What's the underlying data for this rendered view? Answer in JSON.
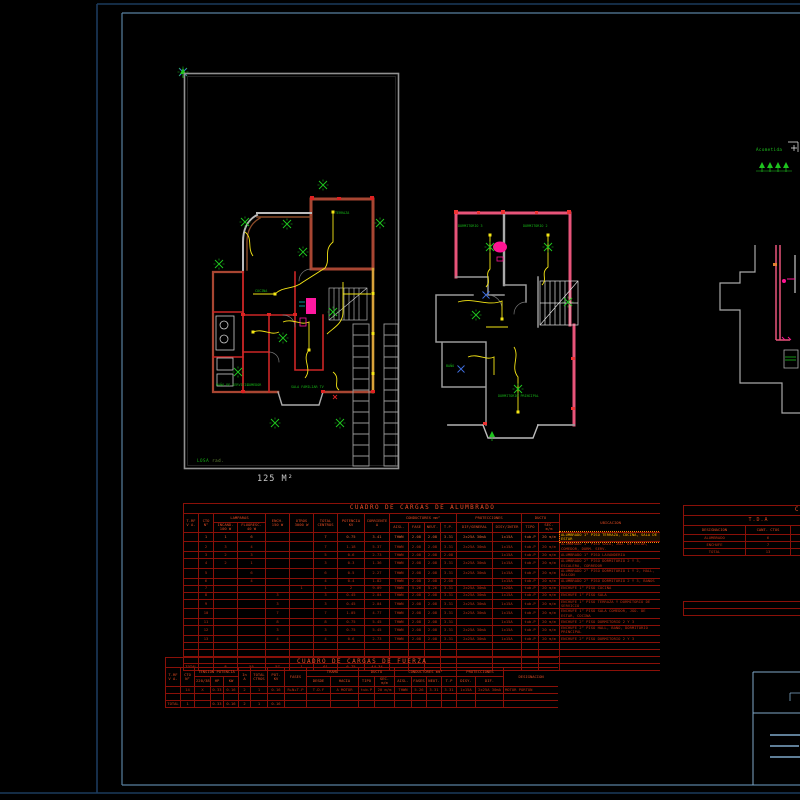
{
  "annotation": {
    "text": "Acometida"
  },
  "plans": {
    "plan1": {
      "area_label": "125 M²",
      "note": "LOSA",
      "note2": "rad.",
      "rooms": {
        "terraza": "TERRAZA",
        "cocina": "COCINA",
        "bano_servicio": "BAÑO DE\nSERVICIO",
        "comedor": "COMEDOR",
        "sala_tv": "SALA\nFAMILIAR TV"
      }
    },
    "plan2": {
      "rooms": {
        "dorm3": "DORMITORIO\n3",
        "dorm2": "DORMITORIO\n2",
        "bano": "BAÑO",
        "dorm_ppal": "DORMITORIO\nPRINCIPAL"
      }
    }
  },
  "colors": {
    "background": "#000000",
    "frame_outer": "#1b3a5c",
    "frame_inner": "#58809f",
    "titleblock": "#7fa8c9",
    "table_line": "#8a1008",
    "table_text": "#c23012",
    "highlight": "#ffb400",
    "wall_orange": "#a84632",
    "wall_pink": "#e8547a",
    "wire_yellow": "#f5e615",
    "symbol_green": "#1ec41e",
    "boundary_gray": "#909090"
  },
  "tables": [
    {
      "id": "alumbrado",
      "title": "CUADRO DE CARGAS DE ALUMBRADO",
      "col_widths": [
        15,
        15,
        24,
        28,
        24,
        24,
        24,
        27,
        25,
        19,
        16,
        16,
        16,
        36,
        29,
        17,
        21,
        102
      ],
      "header_rows": [
        [
          {
            "t": "CUADRO DE CARGAS DE ALUMBRADO",
            "cs": 18,
            "cls": "title"
          }
        ],
        [
          {
            "t": "T.RF\nV A.",
            "rs": 2
          },
          {
            "t": "CTO\nN°",
            "rs": 2
          },
          {
            "t": "LAMPARAS",
            "cs": 2
          },
          {
            "t": "ENCH.\n150 W",
            "rs": 2
          },
          {
            "t": "OTROS\n3000 W",
            "rs": 2
          },
          {
            "t": "TOTAL\nCENTROS",
            "rs": 2
          },
          {
            "t": "POTENCIA\nKV",
            "rs": 2
          },
          {
            "t": "CORRIENTE\nA",
            "rs": 2
          },
          {
            "t": "CONDUCTORES mm²",
            "cs": 4
          },
          {
            "t": "PROTECCIONES",
            "cs": 2
          },
          {
            "t": "DUCTO",
            "cs": 2
          },
          {
            "t": "UBICACION",
            "rs": 2
          }
        ],
        [
          {
            "t": "INCAND.\n100 W"
          },
          {
            "t": "FLUORESC.\n40 W"
          },
          {
            "t": "AISL."
          },
          {
            "t": "FASE"
          },
          {
            "t": "NEUT."
          },
          {
            "t": "T.P."
          },
          {
            "t": "DIF/GENERAL"
          },
          {
            "t": "DISY/INTER"
          },
          {
            "t": "TIPO"
          },
          {
            "t": "SEC. m/m"
          }
        ]
      ],
      "highlight_row": 0,
      "rows": [
        [
          "",
          "1",
          "1",
          "6",
          "",
          "",
          "7",
          "0.75",
          "3.41",
          "THWN",
          "2.08",
          "2.08",
          "3.31",
          "2x25A 30mA",
          "1x15A",
          "tub.P",
          "20 m/m",
          "ALUMBRADO 1° PISO TERRAZA, COCINA, SALA DE ESTAR"
        ],
        [
          "",
          "2",
          "3",
          "4",
          "",
          "",
          "7",
          "1.18",
          "5.37",
          "THWN",
          "2.08",
          "2.08",
          "3.31",
          "2x25A 30mA",
          "1x15A",
          "tub.P",
          "20 m/m",
          "ALUMBRADO 1° PISO SALA, JGO. DE ESTAR, COMEDOR, DORM. SERV."
        ],
        [
          "",
          "3",
          "2",
          "3",
          "",
          "",
          "5",
          "0.6",
          "2.73",
          "THWN",
          "2.08",
          "2.08",
          "2.08",
          "",
          "1x15A",
          "tub.P",
          "20 m/m",
          "ALUMBRADO 1° PISO LAVANDERIA"
        ],
        [
          "",
          "4",
          "2",
          "1",
          "",
          "",
          "3",
          "0.3",
          "1.36",
          "THWN",
          "2.08",
          "2.08",
          "3.31",
          "2x25A 30mA",
          "1x15A",
          "tub.P",
          "20 m/m",
          "ALUMBRADO 2° PISO DORMITORIO 2 Y 3, ESCALERA, CORREDOR"
        ],
        [
          "",
          "5",
          "",
          "6",
          "",
          "",
          "6",
          "0.5",
          "2.27",
          "THWN",
          "2.08",
          "2.08",
          "3.31",
          "2x25A 30mA",
          "1x15A",
          "tub.P",
          "20 m/m",
          "ALUMBRADO 2° PISO DORMITORIO 1 Y 2, HALL, BALCON"
        ],
        [
          "",
          "6",
          "",
          "4",
          "",
          "",
          "4",
          "0.4",
          "1.82",
          "THWN",
          "2.08",
          "2.08",
          "2.08",
          "",
          "1x15A",
          "tub.P",
          "20 m/m",
          "ALUMBRADO 2° PISO DORMITORIO 2 Y 3, BAÑOS"
        ],
        [
          "",
          "7",
          "",
          "",
          "",
          "1",
          "1",
          "2",
          "9.09",
          "THWN",
          "5.26",
          "5.26",
          "3.31",
          "2x25A 30mA",
          "1x20A",
          "tub.P",
          "20 m/m",
          "ENCHUFE 1° PISO COCINA"
        ],
        [
          "",
          "8",
          "",
          "",
          "3",
          "",
          "3",
          "0.45",
          "2.04",
          "THWN",
          "2.08",
          "2.08",
          "3.31",
          "2x25A 30mA",
          "1x15A",
          "tub.P",
          "20 m/m",
          "ENCHUFE 1° PISO SALA"
        ],
        [
          "",
          "9",
          "",
          "",
          "3",
          "",
          "3",
          "0.45",
          "2.04",
          "THWN",
          "2.08",
          "2.08",
          "3.31",
          "2x25A 30mA",
          "1x15A",
          "tub.P",
          "20 m/m",
          "ENCHUFE 1° PISO TERRAZA Y DORMITORIO DE SERVICIO"
        ],
        [
          "",
          "10",
          "",
          "",
          "7",
          "",
          "7",
          "1.05",
          "4.77",
          "THWN",
          "2.08",
          "2.08",
          "3.31",
          "2x25A 30mA",
          "1x15A",
          "tub.P",
          "20 m/m",
          "ENCHUFE 1° PISO SALA COMEDOR, JGO. DE ESTAR, COCINA"
        ],
        [
          "",
          "11",
          "",
          "",
          "8",
          "",
          "8",
          "0.75",
          "5.45",
          "THWN",
          "2.08",
          "2.08",
          "3.31",
          "",
          "1x15A",
          "tub.P",
          "20 m/m",
          "ENCHUFE 2° PISO DORMITORIO 2 Y 3"
        ],
        [
          "",
          "12",
          "",
          "",
          "3",
          "",
          "3",
          "0.75",
          "5.45",
          "THWN",
          "2.08",
          "2.08",
          "3.31",
          "2x25A 30mA",
          "1x15A",
          "tub.P",
          "20 m/m",
          "ENCHUFE 2° PISO HALL, BAÑO, DORMITORIO PRINCIPAL"
        ],
        [
          "",
          "13",
          "",
          "",
          "4",
          "",
          "4",
          "0.6",
          "2.73",
          "THWN",
          "2.08",
          "2.08",
          "3.31",
          "2x25A 30mA",
          "1x15A",
          "tub.P",
          "20 m/m",
          "ENCHUFE 2° PISO DORMITORIO 2 Y 3"
        ]
      ],
      "empty_rows": 3,
      "total": [
        "TOTAL",
        "",
        "8",
        "55",
        "57",
        "1",
        "61",
        "6.75",
        "44.34",
        "",
        "",
        "",
        "",
        "",
        "",
        "",
        "",
        ""
      ]
    },
    {
      "id": "tda",
      "title": "CUADRO",
      "table_width": 150,
      "col_widths": [
        62,
        45,
        43
      ],
      "header_rows": [
        [
          {
            "t": "CUADRO",
            "cs": 3,
            "cls": "title title-right"
          }
        ],
        [
          {
            "t": "T.D.A",
            "cs": 3,
            "cls": "sub"
          }
        ],
        [
          {
            "t": "DESIGNACION"
          },
          {
            "t": "CANT. CTOS"
          },
          {
            "t": "POTENCIA"
          }
        ]
      ],
      "rows": [
        [
          "ALUMBRADO",
          "6",
          ""
        ],
        [
          "ENCHUFE",
          "7",
          ""
        ],
        [
          "TOTAL",
          "13",
          ""
        ]
      ]
    },
    {
      "id": "tda-extra",
      "table_width": 150,
      "col_widths": [
        150
      ],
      "rows": [
        [
          ""
        ],
        [
          ""
        ]
      ]
    },
    {
      "id": "fuerza",
      "title": "CUADRO DE CARGAS DE FUERZA",
      "col_widths": [
        15,
        14,
        16,
        13,
        15,
        12,
        17,
        17,
        22,
        24,
        28,
        16,
        20,
        17,
        15,
        15,
        15,
        19,
        28,
        55
      ],
      "header_rows": [
        [
          {
            "t": "CUADRO DE CARGAS DE FUERZA",
            "cs": 20,
            "cls": "title"
          }
        ],
        [
          {
            "t": "T.RF\nV A.",
            "rs": 2
          },
          {
            "t": "CTO\nN°",
            "rs": 2
          },
          {
            "t": "TENSION POTENCIA",
            "cs": 3
          },
          {
            "t": "In\nA",
            "rs": 2
          },
          {
            "t": "TOTAL\nCTROS",
            "rs": 2
          },
          {
            "t": "POT.\nKV",
            "rs": 2
          },
          {
            "t": "FASES",
            "rs": 2
          },
          {
            "t": "TRAMO",
            "cs": 2
          },
          {
            "t": "DUCTO",
            "cs": 2
          },
          {
            "t": "CONDUCTORES mm²",
            "cs": 4
          },
          {
            "t": "PROTECCIONES",
            "cs": 2
          },
          {
            "t": "DESIGNACION",
            "rs": 2
          }
        ],
        [
          {
            "t": "220/380"
          },
          {
            "t": "HP"
          },
          {
            "t": "KW"
          },
          {
            "t": "DESDE"
          },
          {
            "t": "HACIA"
          },
          {
            "t": "TIPO"
          },
          {
            "t": "SEC. m/m"
          },
          {
            "t": "AISL."
          },
          {
            "t": "FASES"
          },
          {
            "t": "NEUT."
          },
          {
            "t": "T.P"
          },
          {
            "t": "DISY."
          },
          {
            "t": "DIF."
          }
        ]
      ],
      "rows": [
        [
          "",
          "14",
          "X",
          "0.33",
          "0.16",
          "2",
          "1",
          "0.16",
          "R+N+T.P",
          "T.D.F",
          "A MOTOR",
          "tub.P",
          "20 m/m",
          "THWN",
          "5.26",
          "3.31",
          "3.31",
          "1x15A",
          "2x25A 30mA",
          "MOTOR PORTON"
        ]
      ],
      "empty_rows": 1,
      "total": [
        "TOTAL",
        "1",
        "",
        "0.33",
        "0.16",
        "2",
        "1",
        "0.16",
        "",
        "",
        "",
        "",
        "",
        "",
        "",
        "",
        "",
        "",
        "",
        ""
      ]
    }
  ]
}
